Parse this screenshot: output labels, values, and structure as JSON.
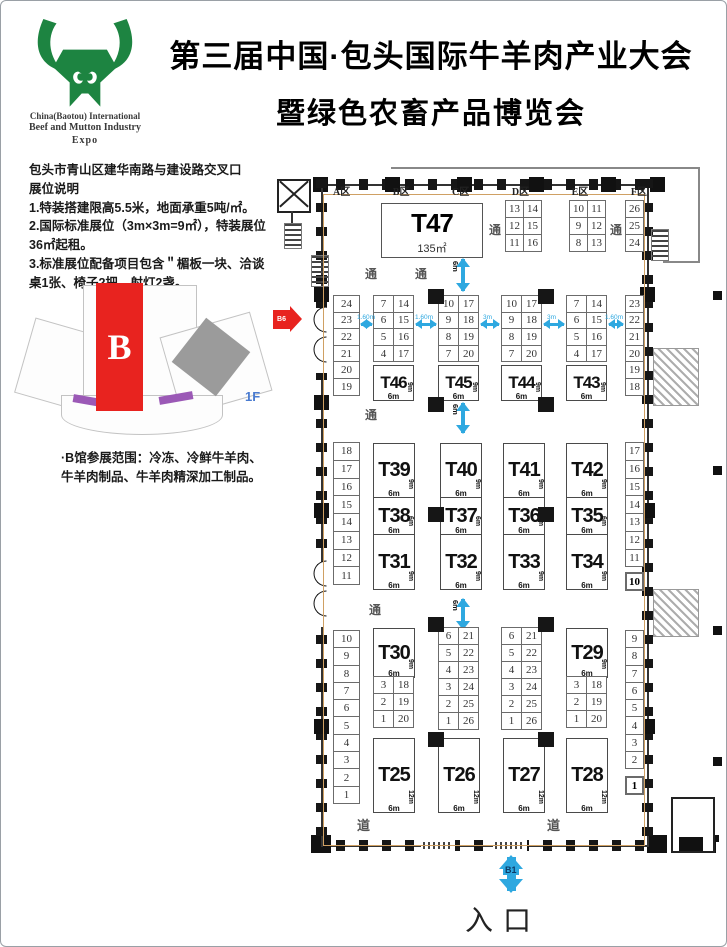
{
  "colors": {
    "brand_green": "#1d8441",
    "accent_red": "#e8231f",
    "arrow_blue": "#2ea8e0",
    "boundary_tan": "#cfa063"
  },
  "header": {
    "title_line1": "第三届中国·包头国际牛羊肉产业大会",
    "title_line2": "暨绿色农畜产品博览会",
    "logo_line1": "China(Baotou) International",
    "logo_line2": "Beef and Mutton Industry",
    "logo_line3": "Expo"
  },
  "info": {
    "address": "包头市青山区建华南路与建设路交叉口",
    "heading": "展位说明",
    "note1": "1.特装搭建限高5.5米，地面承重5吨/㎡。",
    "note2": "2.国际标准展位（3m×3m=9㎡），特装展位36㎡起租。",
    "note3": "3.标准展位配备项目包含＂楣板一块、洽谈桌1张、椅子2把、射灯2盏。",
    "scope": "·B馆参展范围：冷冻、冷鲜牛羊肉、牛羊肉制品、牛羊肉精深加工制品。",
    "hall_letter": "B",
    "floor_tag": "1F"
  },
  "plan": {
    "zones": [
      "A区",
      "B区",
      "C区",
      "D区",
      "E区",
      "F区"
    ],
    "aisle": "通",
    "road": "道",
    "entrance": "入口",
    "b1": "B1",
    "b6": "B6",
    "m6": "6m",
    "t47": {
      "name": "T47",
      "area": "135㎡"
    },
    "grid_d": {
      "c1": [
        13,
        12,
        11
      ],
      "c2": [
        14,
        15,
        16
      ]
    },
    "grid_e": {
      "c1": [
        10,
        9,
        8
      ],
      "c2": [
        11,
        12,
        13
      ]
    },
    "col_f": [
      26,
      25,
      24
    ],
    "left_top": [
      24,
      23,
      22,
      21,
      20,
      19
    ],
    "right_top": [
      23,
      22,
      21,
      20,
      19,
      18
    ],
    "left_mid": [
      18,
      17,
      16,
      15,
      14,
      13,
      12,
      11
    ],
    "right_mid": [
      17,
      16,
      15,
      14,
      13,
      12,
      11
    ],
    "right_mid_last": "10",
    "left_bot": [
      10,
      9,
      8,
      7,
      6,
      5,
      4,
      3,
      2,
      1
    ],
    "right_bot": [
      9,
      8,
      7,
      6,
      5,
      4,
      3,
      2
    ],
    "right_bot_last": "1",
    "gaps": [
      "1.60m",
      "1.60m",
      "3m",
      "3m",
      "1.60m"
    ],
    "rowA": [
      {
        "c1": [
          7,
          6,
          5,
          4
        ],
        "c2": [
          14,
          15,
          16,
          17
        ],
        "name": "T46",
        "w": "6m",
        "d": "9m"
      },
      {
        "c1": [
          10,
          9,
          8,
          7
        ],
        "c2": [
          17,
          18,
          19,
          20
        ],
        "name": "T45",
        "w": "6m",
        "d": "9m"
      },
      {
        "c1": [
          10,
          9,
          8,
          7
        ],
        "c2": [
          17,
          18,
          19,
          20
        ],
        "name": "T44",
        "w": "6m",
        "d": "9m"
      },
      {
        "c1": [
          7,
          6,
          5,
          4
        ],
        "c2": [
          14,
          15,
          16,
          17
        ],
        "name": "T43",
        "w": "6m",
        "d": "9m"
      }
    ],
    "rowB": [
      {
        "top": {
          "name": "T39",
          "w": "6m",
          "d": "9m"
        },
        "mid": {
          "name": "T38",
          "w": "6m",
          "d": "6m"
        },
        "bot": {
          "name": "T31",
          "w": "6m",
          "d": "9m"
        }
      },
      {
        "top": {
          "name": "T40",
          "w": "6m",
          "d": "9m"
        },
        "mid": {
          "name": "T37",
          "w": "6m",
          "d": "6m"
        },
        "bot": {
          "name": "T32",
          "w": "6m",
          "d": "9m"
        }
      },
      {
        "top": {
          "name": "T41",
          "w": "6m",
          "d": "9m"
        },
        "mid": {
          "name": "T36",
          "w": "6m",
          "d": "6m"
        },
        "bot": {
          "name": "T33",
          "w": "6m",
          "d": "9m"
        }
      },
      {
        "top": {
          "name": "T42",
          "w": "6m",
          "d": "9m"
        },
        "mid": {
          "name": "T35",
          "w": "6m",
          "d": "6m"
        },
        "bot": {
          "name": "T34",
          "w": "6m",
          "d": "9m"
        }
      }
    ],
    "rowC": {
      "g1": {
        "name": "T30",
        "w": "6m",
        "d": "9m",
        "c1": [
          3,
          2,
          1
        ],
        "c2": [
          18,
          19,
          20
        ]
      },
      "g2": {
        "c1": [
          6,
          5,
          4,
          3,
          2,
          1
        ],
        "c2": [
          21,
          22,
          23,
          24,
          25,
          26
        ]
      },
      "g3": {
        "c1": [
          6,
          5,
          4,
          3,
          2,
          1
        ],
        "c2": [
          21,
          22,
          23,
          24,
          25,
          26
        ]
      },
      "g4": {
        "name": "T29",
        "w": "6m",
        "d": "9m",
        "c1": [
          3,
          2,
          1
        ],
        "c2": [
          18,
          19,
          20
        ]
      }
    },
    "rowD": [
      {
        "name": "T25",
        "w": "6m",
        "d": "12m"
      },
      {
        "name": "T26",
        "w": "6m",
        "d": "12m"
      },
      {
        "name": "T27",
        "w": "6m",
        "d": "12m"
      },
      {
        "name": "T28",
        "w": "6m",
        "d": "12m"
      }
    ]
  }
}
